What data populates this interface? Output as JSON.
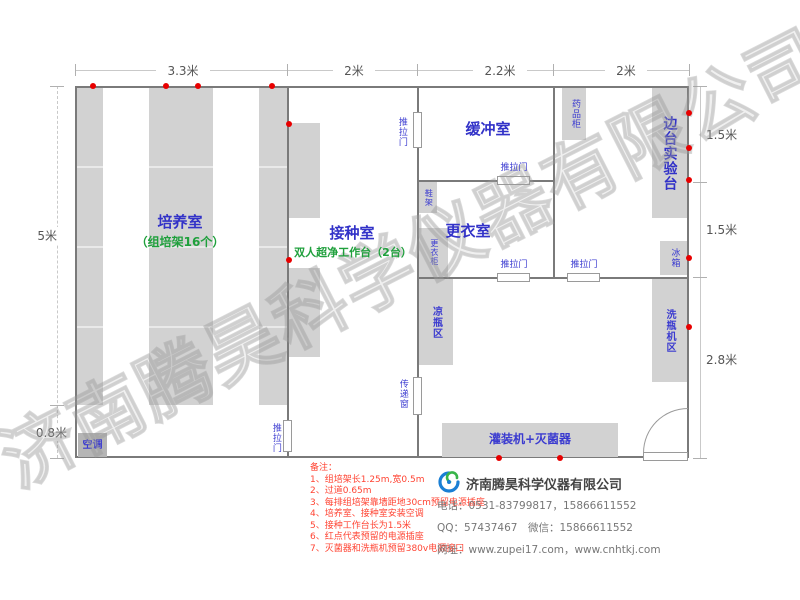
{
  "watermark": "济南腾昊科学仪器有限公司",
  "dims": {
    "top": [
      "3.3米",
      "2米",
      "2.2米",
      "2米"
    ],
    "left": [
      "5米",
      "0.8米"
    ],
    "right": [
      "1.5米",
      "1.5米",
      "2.8米"
    ]
  },
  "rooms": {
    "culture": {
      "name": "培养室",
      "sub": "（组培架16个）"
    },
    "inoculation": {
      "name": "接种室",
      "sub": "双人超净工作台（2台）"
    },
    "buffer": {
      "name": "缓冲室"
    },
    "changing": {
      "name": "更衣室"
    },
    "side_bench": {
      "name": "边台实验台"
    }
  },
  "fixtures": {
    "sliding_door": "推拉门",
    "transfer_window": "传递窗",
    "shoe_rack": "鞋架",
    "locker": "更衣柜",
    "medicine_cabinet": "药品柜",
    "fridge": "冰箱",
    "washer_area": "洗瓶机区",
    "cooling_area": "凉瓶区",
    "filler_sterilizer": "灌装机+灭菌器",
    "air_conditioner": "空调"
  },
  "notes": {
    "title": "备注：",
    "items": [
      "1、组培架长1.25m,宽0.5m",
      "2、过道0.65m",
      "3、每排组培架靠墙距地30cm预留电源插座",
      "4、培养室、接种室安装空调",
      "5、接种工作台长为1.5米",
      "6、红点代表预留的电源插座",
      "7、灭菌器和洗瓶机预留380v电源接口"
    ]
  },
  "footer": {
    "company": "济南腾昊科学仪器有限公司",
    "phone": "电话：0531-83799817，15866611552",
    "qq_wechat": "QQ：57437467　微信：15866611552",
    "website": "网址：www.zupei17.com，www.cnhtkj.com"
  },
  "colors": {
    "wall": "#7a7a7a",
    "furniture_fill": "#d2d2d2",
    "room_label_blue": "#3232c8",
    "sub_label_green": "#1fa03c",
    "socket_red": "#e80000",
    "notes_red": "#ff4433",
    "logo_blue": "#1a7fd4",
    "logo_green": "#39b54a"
  }
}
